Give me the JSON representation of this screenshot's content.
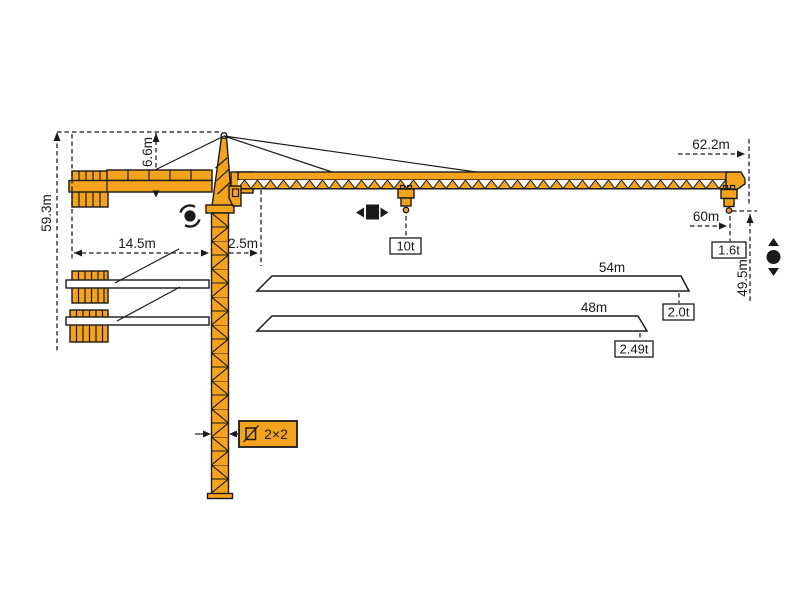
{
  "colors": {
    "crane_orange": "#F5A21C",
    "line_black": "#1a1a1a",
    "label_bg": "#ffffff"
  },
  "crane": {
    "dimensions": {
      "total_height": "59.3m",
      "tower_head_height": "6.6m",
      "counterjib_radius": "14.5m",
      "rear_clearance": "2.5m",
      "jib_length": "62.2m",
      "max_hook_radius": "60m",
      "hook_height": "49.5m",
      "mast_section": "2×2"
    },
    "capacities": {
      "max_load": "10t",
      "tip_load": "1.6t"
    },
    "alternate_jibs": [
      {
        "length": "54m",
        "tip_load": "2.0t"
      },
      {
        "length": "48m",
        "tip_load": "2.49t"
      }
    ],
    "icons": {
      "slew": "slew-icon",
      "trolley_travel": "trolley-travel-icon",
      "hoist": "hoist-icon",
      "mast_section": "mast-section-icon"
    }
  }
}
